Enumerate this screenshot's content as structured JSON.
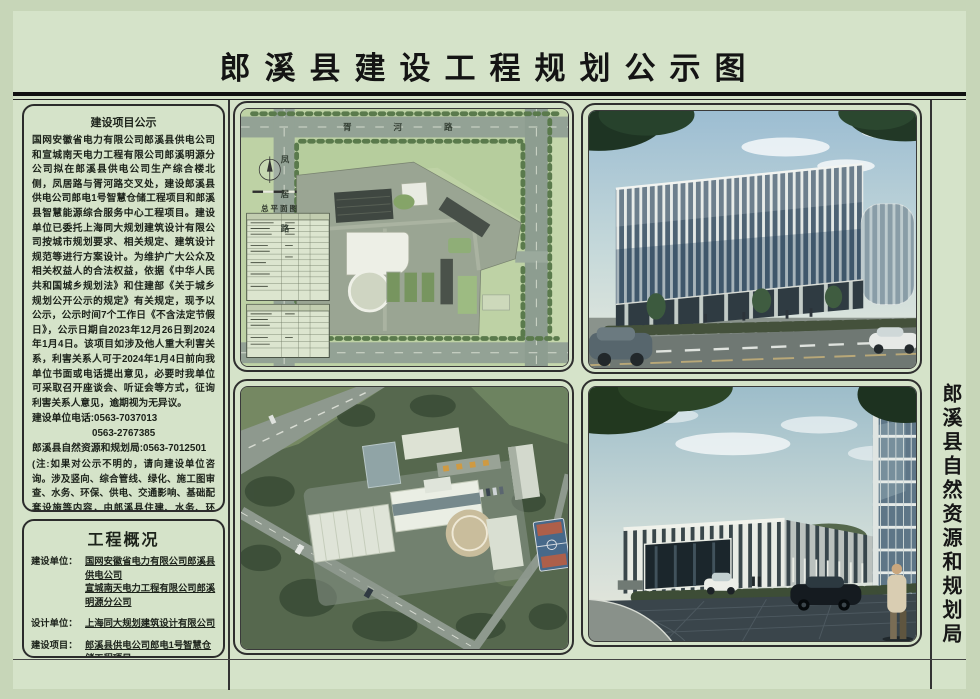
{
  "page": {
    "title": "郎溪县建设工程规划公示图"
  },
  "notice_panel": {
    "title": "建设项目公示",
    "body": "国网安徽省电力有限公司郎溪县供电公司和宣城南天电力工程有限公司郎溪明源分公司拟在郎溪县供电公司生产综合楼北侧，凤居路与胥河路交叉处，建设郎溪县供电公司郎电1号智慧仓储工程项目和郎溪县智慧能源综合服务中心工程项目。建设单位已委托上海同大规划建筑设计有限公司按城市规划要求、相关规定、建筑设计规范等进行方案设计。为维护广大公众及相关权益人的合法权益，依据《中华人民共和国城乡规划法》和住建部《关于城乡规划公开公示的规定》有关规定，现予以公示，公示时间7个工作日《不含法定节假日》，公示日期自2023年12月26日到2024年1月4日。该项目如涉及他人重大利害关系，利害关系人可于2024年1月4日前向我单位书面或电话提出意见，必要时我单位可采取召开座谈会、听证会等方式，征询利害关系人意见，逾期视为无异议。",
    "phone_line1": "建设单位电话:0563-7037013",
    "phone_line2": "0563-2767385",
    "phone_line3": "郎溪县自然资源和规划局:0563-7012501",
    "note": "(注:如果对公示不明的，请向建设单位咨询。涉及竖向、综合管线、绿化、施工图审查、水务、环保、供电、交通影响、基础配套设施等内容，由郎溪县住建、水务、环保、供电、交警等主管部门审查，监管或实施前按程序另行公示。)",
    "signature": "郎溪县自然资源和规划局",
    "date": "2023年12月26日"
  },
  "overview_panel": {
    "title": "工程概况",
    "rows": [
      {
        "label": "建设单位：",
        "lines": [
          "国网安徽省电力有限公司郎溪县供电公司",
          "宣城南天电力工程有限公司郎溪明源分公司"
        ]
      },
      {
        "label": "设计单位：",
        "lines": [
          "上海同大规划建筑设计有限公司"
        ]
      },
      {
        "label": "建设项目：",
        "lines": [
          "郎溪县供电公司郎电1号智慧仓储工程项目",
          "郎溪县智慧能源综合服务中心工程项目"
        ]
      }
    ]
  },
  "site_plan": {
    "label": "总平面图",
    "road_top": "胥河路",
    "road_left": "凤居路"
  },
  "right_strip": {
    "text": "郎溪县自然资源和规划局"
  },
  "colors": {
    "sheet_green": "#d5e3c9",
    "margin_green": "#c7d6b8",
    "line_black": "#111111",
    "plan_green": "#bed2a5",
    "road_gray": "#93a295",
    "sky_blue": "#9cbdd2",
    "glass_blue": "#4e6374",
    "hedge_green": "#44513b",
    "court_blue": "#47698a",
    "court_red": "#ad5f4a"
  }
}
